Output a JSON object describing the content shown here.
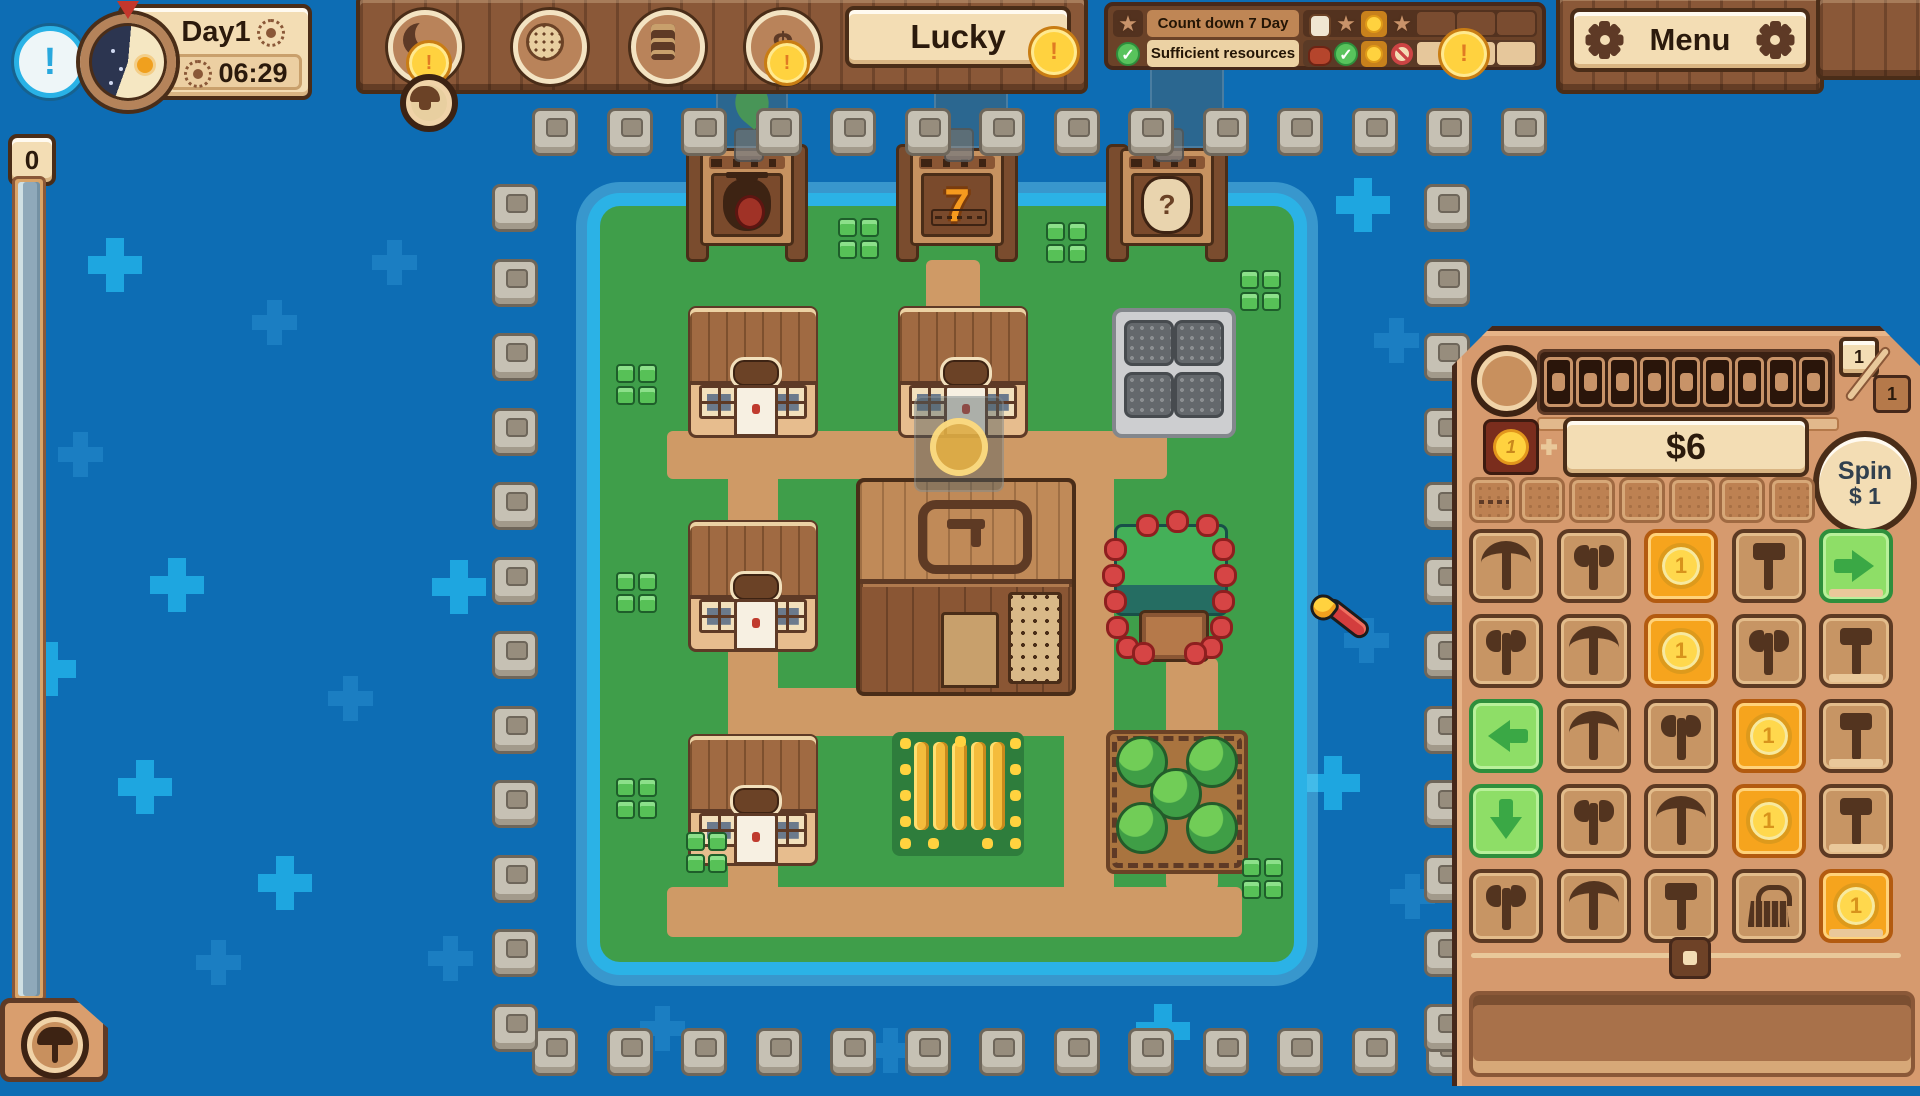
{
  "colors": {
    "bg_blue": "#0d6db4",
    "water_teal": "#2bb2e6",
    "grass": "#3f9e4a",
    "path": "#cf9a66",
    "panel_tan": "#d69a6e",
    "cream": "#f3ddb4",
    "wood": "#8a5838",
    "coin_gold": "#ffd23f",
    "slot_orange": "#f6a41d",
    "arrow_green": "#8ede67"
  },
  "hud": {
    "alert_char": "!",
    "day_label": "Day1",
    "time": "06:29",
    "banner_label": "Lucky",
    "menu_label": "Menu",
    "resource_counter": "0",
    "coin_alert_char": "!",
    "buttons": [
      {
        "icon": "moon-phase",
        "cx": 420,
        "badge": true
      },
      {
        "icon": "lion-medal",
        "cx": 545,
        "badge": false
      },
      {
        "icon": "ledger-book",
        "cx": 663,
        "badge": false
      },
      {
        "icon": "dollar",
        "glyph": "$",
        "cx": 778,
        "badge": true
      }
    ],
    "quests": {
      "rows": [
        {
          "lead_icon": "star",
          "title": "Count down 7 Day",
          "icons": [
            "villager",
            "star",
            "coin",
            "star"
          ],
          "empty": 3
        },
        {
          "lead_icon": "check",
          "title": "Sufficient resources",
          "icons": [
            "meat",
            "check",
            "coin",
            "no"
          ],
          "empty": 3
        }
      ]
    }
  },
  "slot_panel": {
    "pages_top": "1",
    "pages_bottom": "1",
    "reel_windows": 9,
    "bet_coin_face": "1",
    "coin_face": "1",
    "money_display": "$6",
    "spin_label": "Spin",
    "spin_cost": "$ 1",
    "tray_slots": 7,
    "grid": [
      [
        "pickaxe",
        "axe",
        "coin",
        "hammer",
        "arrow-right"
      ],
      [
        "axe",
        "pickaxe",
        "coin",
        "axe",
        "hammer"
      ],
      [
        "arrow-left",
        "pickaxe",
        "axe",
        "coin",
        "hammer"
      ],
      [
        "arrow-down",
        "axe",
        "pickaxe",
        "coin",
        "hammer"
      ],
      [
        "axe",
        "pickaxe",
        "hammer",
        "basket",
        "coin"
      ]
    ]
  },
  "map": {
    "cursor": {
      "type": "match",
      "x": 1296,
      "y": 600
    },
    "structures": [
      {
        "type": "sign",
        "variant": "moneybag",
        "label": "",
        "x": 690,
        "y": 140,
        "w": 114,
        "h": 122
      },
      {
        "type": "sign",
        "variant": "seven",
        "label": "7",
        "x": 900,
        "y": 140,
        "w": 114,
        "h": 122
      },
      {
        "type": "sign",
        "variant": "question",
        "label": "?",
        "x": 1110,
        "y": 140,
        "w": 114,
        "h": 122
      },
      {
        "type": "house",
        "x": 688,
        "y": 306,
        "w": 124,
        "h": 126
      },
      {
        "type": "house",
        "x": 898,
        "y": 306,
        "w": 124,
        "h": 126
      },
      {
        "type": "quarry",
        "x": 1112,
        "y": 308,
        "w": 116,
        "h": 122
      },
      {
        "type": "house",
        "x": 688,
        "y": 520,
        "w": 124,
        "h": 126
      },
      {
        "type": "hall",
        "x": 856,
        "y": 478,
        "w": 212,
        "h": 210
      },
      {
        "type": "berry",
        "x": 1108,
        "y": 520,
        "w": 126,
        "h": 148
      },
      {
        "type": "house",
        "x": 688,
        "y": 734,
        "w": 124,
        "h": 126
      },
      {
        "type": "wheat",
        "x": 892,
        "y": 732,
        "w": 132,
        "h": 124
      },
      {
        "type": "orchard",
        "x": 1106,
        "y": 730,
        "w": 134,
        "h": 136
      }
    ],
    "paths": [
      [
        667,
        431,
        500,
        48
      ],
      [
        728,
        431,
        50,
        506
      ],
      [
        926,
        260,
        54,
        175
      ],
      [
        1064,
        431,
        50,
        506
      ],
      [
        728,
        688,
        386,
        48
      ],
      [
        667,
        887,
        575,
        50
      ],
      [
        1166,
        658,
        52,
        232
      ]
    ],
    "sprout_patches": [
      [
        838,
        218
      ],
      [
        1046,
        222
      ],
      [
        1240,
        270
      ],
      [
        616,
        364
      ],
      [
        616,
        572
      ],
      [
        616,
        778
      ],
      [
        1242,
        858
      ],
      [
        686,
        832
      ]
    ],
    "ghost_previews": [
      {
        "variant": "leaf",
        "x": 716,
        "y": 58,
        "w": 68,
        "h": 86
      },
      {
        "variant": "tile",
        "x": 934,
        "y": 54,
        "w": 70,
        "h": 90
      },
      {
        "variant": "tile",
        "x": 1150,
        "y": 54,
        "w": 70,
        "h": 90
      },
      {
        "variant": "coin",
        "x": 914,
        "y": 396,
        "w": 86,
        "h": 92
      }
    ]
  },
  "scene": {
    "water_crosses": [
      [
        88,
        238,
        1
      ],
      [
        252,
        300,
        0
      ],
      [
        58,
        432,
        0
      ],
      [
        150,
        558,
        1
      ],
      [
        22,
        642,
        1
      ],
      [
        118,
        760,
        1
      ],
      [
        328,
        676,
        0
      ],
      [
        258,
        856,
        1
      ],
      [
        428,
        936,
        0
      ],
      [
        196,
        940,
        0
      ],
      [
        688,
        178,
        1
      ],
      [
        1336,
        178,
        1
      ],
      [
        1374,
        318,
        0
      ],
      [
        1344,
        618,
        0
      ],
      [
        1306,
        756,
        1
      ],
      [
        1390,
        874,
        0
      ],
      [
        640,
        1006,
        0
      ],
      [
        868,
        1028,
        0
      ],
      [
        1136,
        1004,
        1
      ],
      [
        372,
        240,
        0
      ],
      [
        432,
        560,
        1
      ]
    ],
    "dock_posts": {
      "top": {
        "x": 532,
        "y": 108,
        "count": 14,
        "dx": 74.5
      },
      "bottom": {
        "x": 532,
        "y": 1028,
        "count": 14,
        "dx": 74.5
      },
      "left": {
        "x": 492,
        "y": 184,
        "count": 12,
        "dy": 74.5
      },
      "right": {
        "x": 1424,
        "y": 184,
        "count": 12,
        "dy": 74.5
      }
    }
  }
}
